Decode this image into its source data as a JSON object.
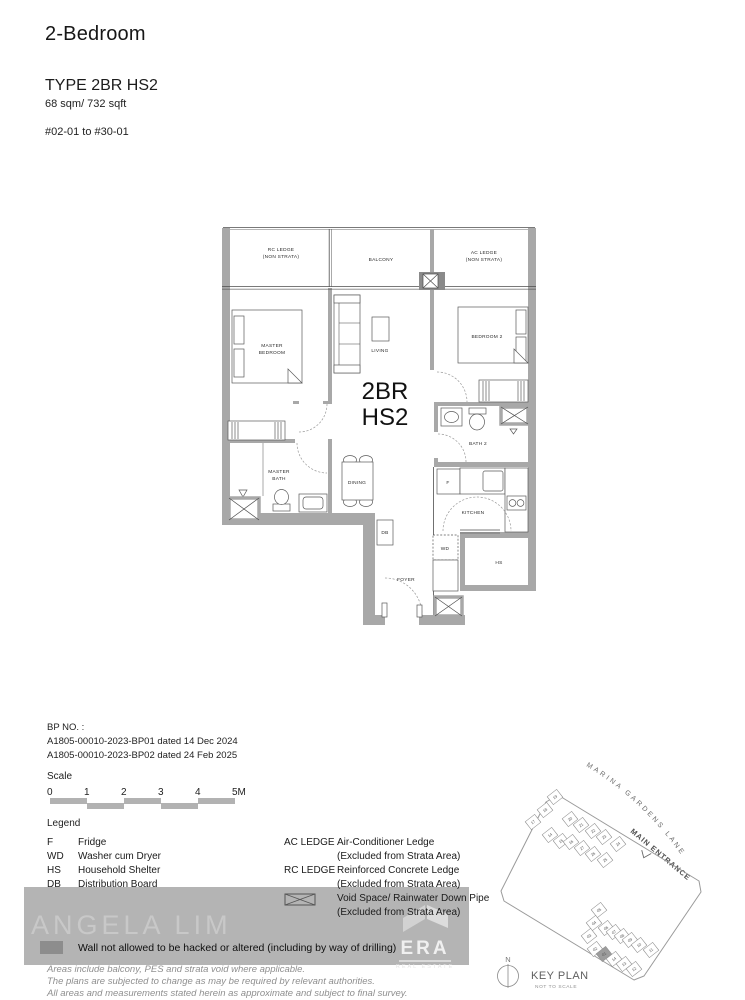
{
  "header": {
    "title": "2-Bedroom",
    "type": "TYPE 2BR HS2",
    "area": "68 sqm/ 732 sqft",
    "units": "#02-01 to #30-01"
  },
  "plan": {
    "unit_1": "2BR",
    "unit_2": "HS2",
    "rc_ledge_1": "RC LEDGE",
    "rc_ledge_2": "(NON STRATA)",
    "balcony": "BALCONY",
    "ac_ledge_1": "AC LEDGE",
    "ac_ledge_2": "(NON STRATA)",
    "master_bedroom_1": "MASTER",
    "master_bedroom_2": "BEDROOM",
    "living": "LIVING",
    "bedroom2": "BEDROOM 2",
    "master_bath_1": "MASTER",
    "master_bath_2": "BATH",
    "dining": "DINING",
    "bath2": "BATH 2",
    "fridge": "F",
    "kitchen": "KITCHEN",
    "db": "DB",
    "wd": "WD",
    "hs": "HS",
    "foyer": "FOYER"
  },
  "bp": {
    "label": "BP NO. :",
    "lines": [
      "A1805-00010-2023-BP01 dated 14 Dec 2024",
      "A1805-00010-2023-BP02 dated 24 Feb 2025"
    ]
  },
  "scale": {
    "label": "Scale",
    "ticks": [
      "0",
      "1",
      "2",
      "3",
      "4",
      "5M"
    ]
  },
  "legend": {
    "title": "Legend",
    "left": [
      {
        "key": "F",
        "label": "Fridge"
      },
      {
        "key": "WD",
        "label": "Washer cum Dryer"
      },
      {
        "key": "HS",
        "label": "Household Shelter"
      },
      {
        "key": "DB",
        "label": "Distribution Board"
      }
    ],
    "right": [
      {
        "key": "AC LEDGE",
        "label": "Air-Conditioner Ledge"
      },
      {
        "key": "",
        "label": "(Excluded from Strata Area)"
      },
      {
        "key": "RC LEDGE",
        "label": "Reinforced Concrete Ledge"
      },
      {
        "key": "",
        "label": "(Excluded from Strata Area)"
      },
      {
        "key": "",
        "label": "Void Space/ Rainwater Down Pipe"
      },
      {
        "key": "",
        "label": "(Excluded from Strata Area)"
      }
    ],
    "wall_note": "Wall not allowed to be hacked or altered (including by way of drilling)"
  },
  "watermark": {
    "name": "ANGELA LIM"
  },
  "era": {
    "name": "ERA",
    "tagline": "REAL ESTATE"
  },
  "key_plan": {
    "road": "MARINA GARDENS LANE",
    "entrance": "MAIN ENTRANCE",
    "compass": "N",
    "title": "KEY PLAN",
    "subtitle": "NOT TO SCALE",
    "stacks": [
      {
        "n": "19",
        "x": 77,
        "y": 45
      },
      {
        "n": "18",
        "x": 67,
        "y": 58
      },
      {
        "n": "17",
        "x": 55,
        "y": 70
      },
      {
        "n": "20",
        "x": 92,
        "y": 67
      },
      {
        "n": "21",
        "x": 103,
        "y": 73
      },
      {
        "n": "22",
        "x": 115,
        "y": 79
      },
      {
        "n": "23",
        "x": 126,
        "y": 85
      },
      {
        "n": "24",
        "x": 140,
        "y": 92
      },
      {
        "n": "14",
        "x": 72,
        "y": 83
      },
      {
        "n": "15",
        "x": 83,
        "y": 89
      },
      {
        "n": "16",
        "x": 93,
        "y": 90
      },
      {
        "n": "27",
        "x": 104,
        "y": 96
      },
      {
        "n": "26",
        "x": 115,
        "y": 102
      },
      {
        "n": "25",
        "x": 127,
        "y": 108
      },
      {
        "n": "05",
        "x": 121,
        "y": 158
      },
      {
        "n": "04",
        "x": 116,
        "y": 171
      },
      {
        "n": "03",
        "x": 111,
        "y": 184
      },
      {
        "n": "06",
        "x": 128,
        "y": 176
      },
      {
        "n": "07",
        "x": 136,
        "y": 180
      },
      {
        "n": "08",
        "x": 144,
        "y": 184
      },
      {
        "n": "09",
        "x": 152,
        "y": 188
      },
      {
        "n": "10",
        "x": 161,
        "y": 193
      },
      {
        "n": "11",
        "x": 173,
        "y": 198
      },
      {
        "n": "02",
        "x": 117,
        "y": 197
      },
      {
        "n": "01",
        "x": 126,
        "y": 202,
        "hl": true
      },
      {
        "n": "14",
        "x": 136,
        "y": 207
      },
      {
        "n": "13",
        "x": 146,
        "y": 212
      },
      {
        "n": "12",
        "x": 156,
        "y": 217
      }
    ]
  },
  "disclaimers": [
    "Areas include balcony, PES and strata void where applicable.",
    "The plans are subjected to change as may be required by relevant authorities.",
    "All areas and measurements stated herein as approximate and subject to final survey."
  ]
}
